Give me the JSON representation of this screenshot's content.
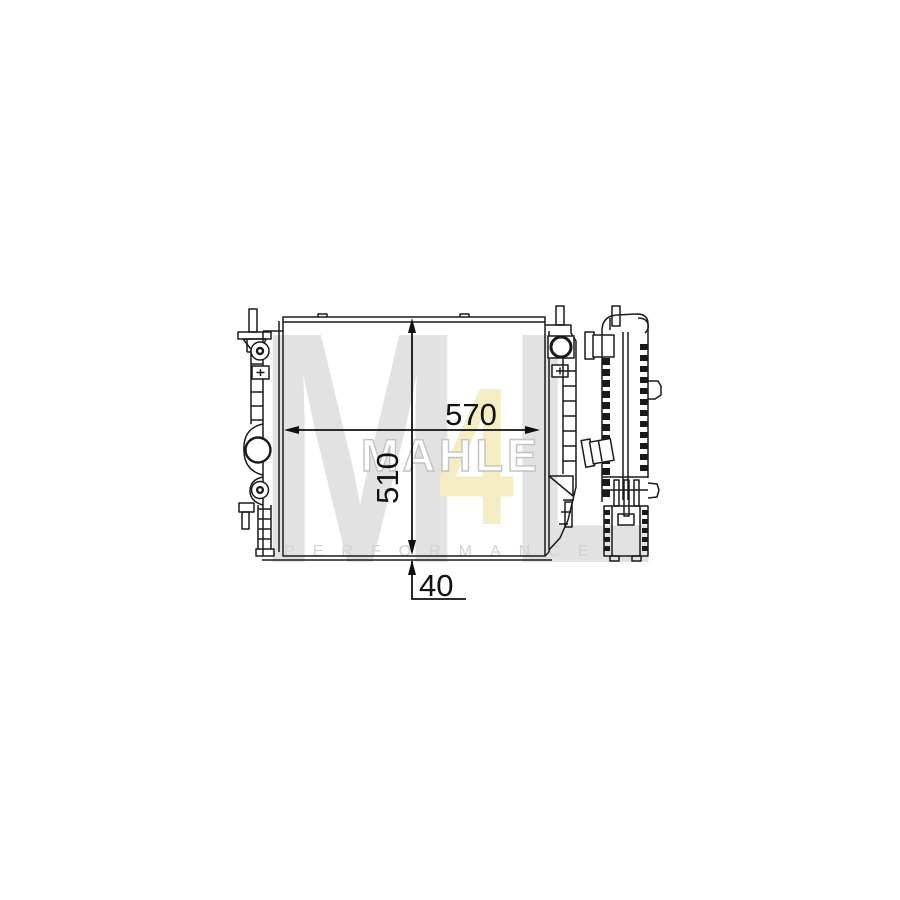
{
  "watermark": {
    "logo": {
      "m": "M",
      "four": "4",
      "l": "L"
    },
    "brand": "MAHLE",
    "tagline": "PERFORMANCE"
  },
  "dimensions": {
    "width_label": "570",
    "height_label": "510",
    "depth_label": "40"
  },
  "colors": {
    "line": "#1a1a1a",
    "dimension_text": "#111111",
    "background": "#ffffff",
    "watermark_gray": "#e2e2e2",
    "watermark_yellow": "#f4edc3",
    "brand_outline_gray": "#c2c2c2",
    "tagline_gray": "#d2d2d2"
  }
}
